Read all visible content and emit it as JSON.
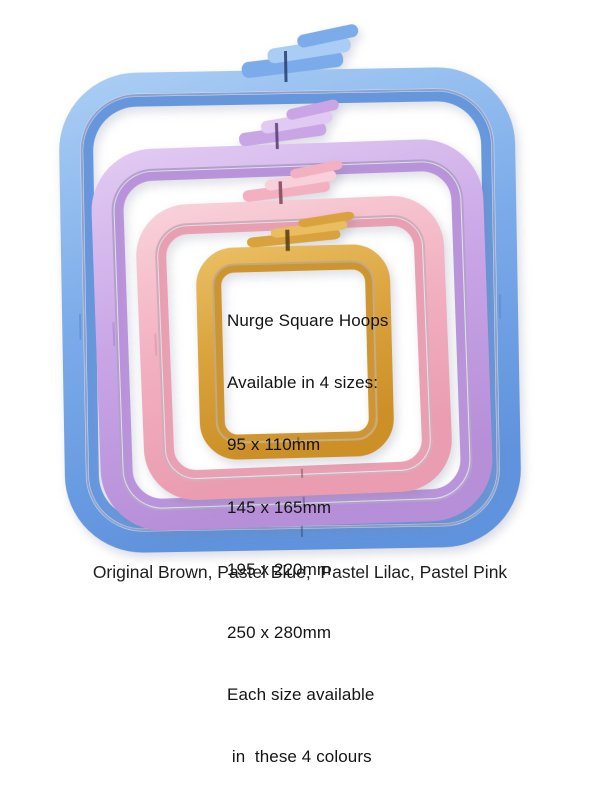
{
  "page": {
    "background": "#ffffff"
  },
  "info_panel": {
    "lines": [
      "Nurge Square Hoops",
      "Available in 4 sizes:",
      "95 x 110mm",
      "145 x 165mm",
      "195 x 220mm",
      "250 x 280mm",
      "Each size available",
      " in  these 4 colours"
    ]
  },
  "caption": {
    "text": "Original Brown, Pastel Blue,  Pastel Lilac, Pastel Pink"
  },
  "hoops": [
    {
      "name": "Pastel Blue",
      "light": "#a9cdf4",
      "main": "#7babe9",
      "deep": "#6093dd",
      "seam": "#4a70bd",
      "slot": "#27406e"
    },
    {
      "name": "Pastel Lilac",
      "light": "#e0c9f2",
      "main": "#c9a5e6",
      "deep": "#b78fd9",
      "seam": "#8f6cb5",
      "slot": "#553a70"
    },
    {
      "name": "Pastel Pink",
      "light": "#f8d0d9",
      "main": "#f2b0c0",
      "deep": "#ea9cb0",
      "seam": "#c97f94",
      "slot": "#7e4456"
    },
    {
      "name": "Original Brown",
      "light": "#e9bd60",
      "main": "#d9a23c",
      "deep": "#cd9027",
      "seam": "#a5761d",
      "slot": "#5f430e"
    }
  ],
  "text_color": "#141414"
}
